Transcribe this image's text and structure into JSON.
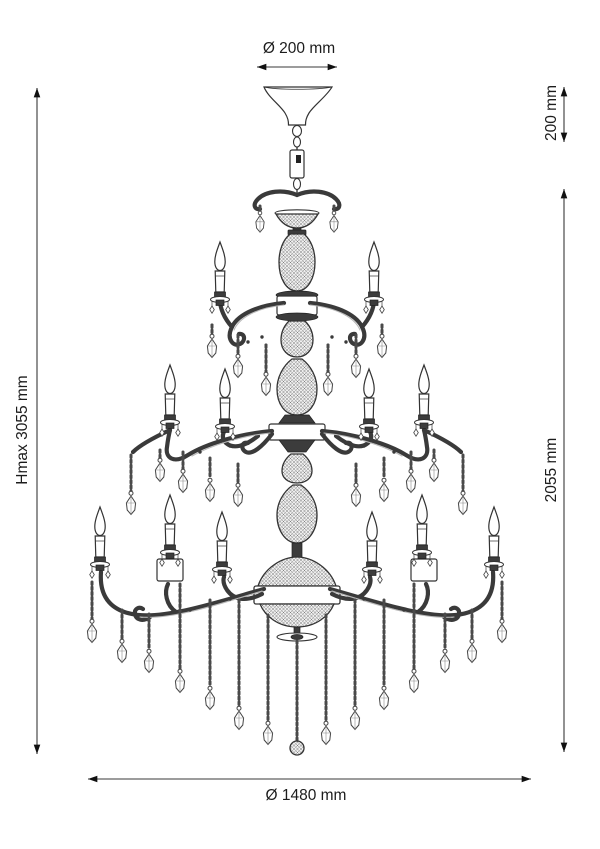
{
  "page": {
    "background": "#ffffff"
  },
  "drawing": {
    "subject": "Three-tier crystal chandelier, technical line engraving",
    "style": "black line drawing on white background",
    "line_color": "#2b2b2b"
  },
  "dimensions": {
    "canopy_diameter": "Ø 200 mm",
    "suspension_height": "200 mm",
    "max_height": "Hmax 3055 mm",
    "body_height": "2055 mm",
    "body_diameter": "Ø 1480 mm"
  }
}
